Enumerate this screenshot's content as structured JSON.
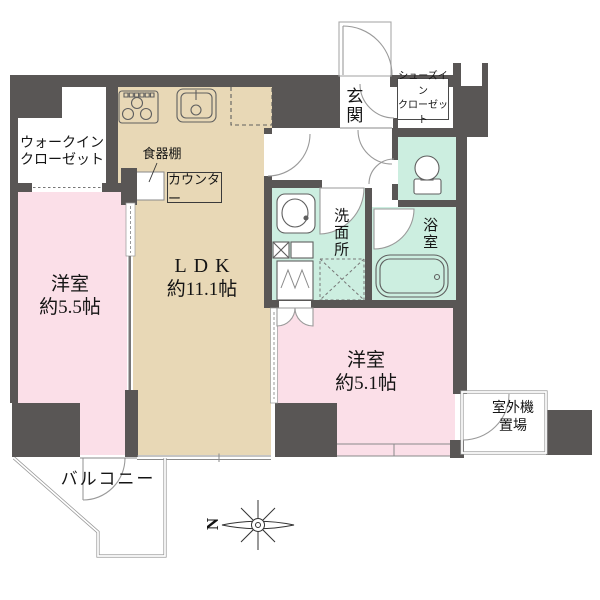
{
  "floorplan": {
    "rooms": {
      "wic": {
        "line1": "ウォークイン",
        "line2": "クローゼット"
      },
      "bedroom_main": {
        "name": "洋室",
        "size": "約5.5帖"
      },
      "ldk": {
        "name": "LDK",
        "size": "約11.1帖"
      },
      "kitchen": {
        "dish_shelf": "食器棚",
        "counter": "カウンター"
      },
      "entrance": {
        "name": "玄関"
      },
      "shoes_closet": {
        "line1": "シューズイン",
        "line2": "クローゼット"
      },
      "washroom": {
        "name": "洗面所"
      },
      "bathroom": {
        "name": "浴室"
      },
      "bedroom_second": {
        "name": "洋室",
        "size": "約5.1帖"
      },
      "outdoor_unit": {
        "line1": "室外機",
        "line2": "置場"
      },
      "balcony": {
        "name": "バルコニー"
      }
    },
    "compass": {
      "north": "N"
    },
    "colors": {
      "wall": "#595655",
      "ldk_floor": "#e8d8b6",
      "bedroom_floor": "#fbdfe8",
      "wet_area_floor": "#cceee0",
      "outline": "#999999",
      "text": "#141414"
    }
  }
}
